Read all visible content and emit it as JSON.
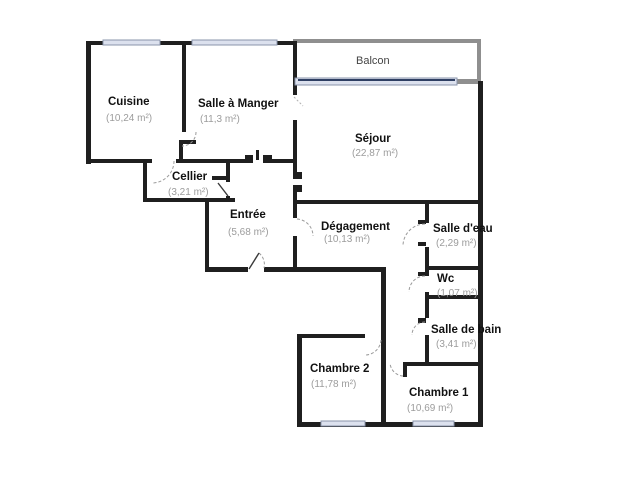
{
  "floorplan": {
    "canvas": {
      "w": 640,
      "h": 500,
      "bg": "#ffffff"
    },
    "colors": {
      "wall": "#1f1f1f",
      "balcony_wall": "#8f8f8f",
      "window_fill": "#dce1ee",
      "window_stroke": "#8a94ab",
      "balcony_window_line": "#2f3f63",
      "door_arc": "#9a9a9a",
      "door_leaf": "#3a3a3a",
      "opening_tick": "#b0b0b0",
      "room_name": "#111111",
      "room_area": "#9c9c9c",
      "light_label": "#444444"
    },
    "walls": [
      [
        86,
        41,
        5,
        123
      ],
      [
        86,
        41,
        209,
        4
      ],
      [
        86,
        159,
        66,
        4
      ],
      [
        176,
        159,
        70,
        4
      ],
      [
        263,
        159,
        32,
        4
      ],
      [
        182,
        41,
        4,
        91
      ],
      [
        179,
        140,
        17,
        4
      ],
      [
        179,
        144,
        4,
        17
      ],
      [
        143,
        159,
        4,
        43
      ],
      [
        143,
        198,
        92,
        4
      ],
      [
        226,
        161,
        4,
        21
      ],
      [
        226,
        196,
        4,
        6
      ],
      [
        205,
        198,
        4,
        74
      ],
      [
        205,
        267,
        43,
        5
      ],
      [
        264,
        267,
        119,
        5
      ],
      [
        381,
        267,
        5,
        160
      ],
      [
        297,
        334,
        68,
        4
      ],
      [
        297,
        334,
        5,
        93
      ],
      [
        297,
        422,
        186,
        5
      ],
      [
        478,
        81,
        5,
        346
      ],
      [
        293,
        41,
        4,
        54
      ],
      [
        293,
        120,
        4,
        41
      ],
      [
        293,
        161,
        4,
        11
      ],
      [
        293,
        192,
        4,
        12
      ],
      [
        293,
        200,
        187,
        4
      ],
      [
        293,
        204,
        4,
        14
      ],
      [
        293,
        236,
        4,
        36
      ],
      [
        425,
        200,
        4,
        23
      ],
      [
        425,
        247,
        4,
        21
      ],
      [
        425,
        266,
        53,
        4
      ],
      [
        425,
        270,
        4,
        6
      ],
      [
        425,
        292,
        4,
        7
      ],
      [
        425,
        295,
        53,
        4
      ],
      [
        425,
        299,
        4,
        19
      ],
      [
        425,
        335,
        4,
        31
      ],
      [
        404,
        362,
        74,
        4
      ]
    ],
    "balcony_walls": [
      [
        293,
        39,
        188,
        4
      ],
      [
        477,
        39,
        4,
        44
      ],
      [
        455,
        79,
        23,
        5
      ]
    ],
    "posts": [
      [
        245,
        155,
        8,
        8
      ],
      [
        263,
        155,
        9,
        8
      ],
      [
        256,
        150,
        3,
        10
      ],
      [
        293,
        172,
        9,
        7
      ],
      [
        293,
        185,
        9,
        7
      ],
      [
        212,
        176,
        14,
        4
      ],
      [
        418,
        220,
        8,
        4
      ],
      [
        418,
        242,
        8,
        4
      ],
      [
        418,
        272,
        8,
        4
      ],
      [
        418,
        318,
        8,
        5
      ],
      [
        403,
        362,
        4,
        15
      ]
    ],
    "windows": [
      [
        103,
        40,
        57,
        5
      ],
      [
        192,
        40,
        85,
        5
      ],
      [
        321,
        421,
        44,
        5
      ],
      [
        413,
        421,
        41,
        5
      ]
    ],
    "balcony_window": {
      "rect": [
        295,
        78,
        162,
        7
      ],
      "line": [
        298,
        80,
        455,
        80
      ]
    },
    "door_arcs": [
      "M 196 132 A 14 14 0 0 1 182 146",
      "M 174 161 A 22 22 0 0 1 152 183",
      "M 297 219 A 17 17 0 0 1 313 236",
      "M 259 253 A 15 15 0 0 1 264 268",
      "M 425 224 A 22 22 0 0 0 403 246",
      "M 425 276 A 16 16 0 0 0 409 292",
      "M 425 322 A 13 13 0 0 0 412 335",
      "M 381 340 A 16 16 0 0 1 365 355",
      "M 403 376 A 14 14 0 0 1 390 363"
    ],
    "door_leaves": [
      [
        249,
        269,
        259,
        253
      ],
      [
        218,
        183,
        228,
        196
      ]
    ],
    "opening_ticks": [
      [
        294,
        97,
        303,
        106
      ]
    ],
    "rooms": [
      {
        "id": "cuisine",
        "name": "Cuisine",
        "area": "(10,24 m²)",
        "name_pos": [
          108,
          105
        ],
        "area_pos": [
          106,
          121
        ]
      },
      {
        "id": "salle-a-manger",
        "name": "Salle à Manger",
        "area": "(11,3 m²)",
        "name_pos": [
          198,
          107
        ],
        "area_pos": [
          200,
          122
        ]
      },
      {
        "id": "balcon",
        "name": "Balcon",
        "area": "",
        "name_pos": [
          356,
          64
        ],
        "area_pos": [
          0,
          0
        ],
        "style": "light"
      },
      {
        "id": "sejour",
        "name": "Séjour",
        "area": "(22,87 m²)",
        "name_pos": [
          355,
          142
        ],
        "area_pos": [
          352,
          156
        ]
      },
      {
        "id": "cellier",
        "name": "Cellier",
        "area": "(3,21 m²)",
        "name_pos": [
          172,
          180
        ],
        "area_pos": [
          168,
          195
        ]
      },
      {
        "id": "entree",
        "name": "Entrée",
        "area": "(5,68 m²)",
        "name_pos": [
          230,
          218
        ],
        "area_pos": [
          228,
          235
        ]
      },
      {
        "id": "degagement",
        "name": "Dégagement",
        "area": "(10,13 m²)",
        "name_pos": [
          321,
          230
        ],
        "area_pos": [
          324,
          242
        ]
      },
      {
        "id": "salle-d-eau",
        "name": "Salle d'eau",
        "area": "(2,29 m²)",
        "name_pos": [
          433,
          232
        ],
        "area_pos": [
          436,
          246
        ]
      },
      {
        "id": "wc",
        "name": "Wc",
        "area": "(1,07 m²)",
        "name_pos": [
          437,
          282
        ],
        "area_pos": [
          437,
          296
        ]
      },
      {
        "id": "salle-de-bain",
        "name": "Salle de bain",
        "area": "(3,41 m²)",
        "name_pos": [
          431,
          333
        ],
        "area_pos": [
          436,
          347
        ]
      },
      {
        "id": "chambre-2",
        "name": "Chambre 2",
        "area": "(11,78 m²)",
        "name_pos": [
          310,
          372
        ],
        "area_pos": [
          311,
          387
        ]
      },
      {
        "id": "chambre-1",
        "name": "Chambre 1",
        "area": "(10,69 m²)",
        "name_pos": [
          409,
          396
        ],
        "area_pos": [
          407,
          411
        ]
      }
    ]
  }
}
